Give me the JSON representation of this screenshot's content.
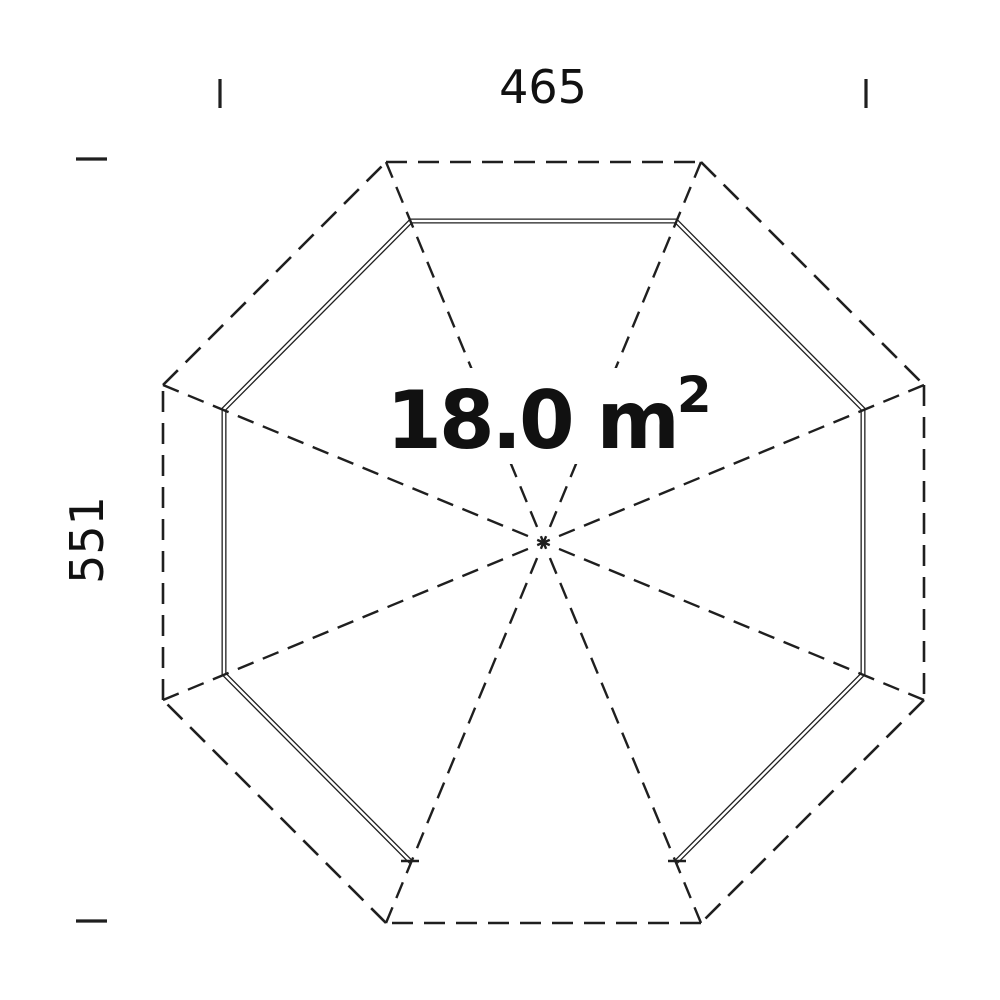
{
  "diagram": {
    "type": "floor-plan",
    "shape": "octagon",
    "area_label": {
      "main": "18.0 m",
      "superscript": "2"
    },
    "dimensions": {
      "width_label": "465",
      "height_label": "551"
    }
  },
  "colors": {
    "line": "#1f1f1f",
    "text": "#111111",
    "background": "#ffffff"
  },
  "geometry": {
    "canvas": {
      "width": 1000,
      "height": 1000
    },
    "center": [
      543.5,
      542.5
    ],
    "outer_octagon": [
      [
        386,
        162
      ],
      [
        701,
        162
      ],
      [
        924,
        385
      ],
      [
        924,
        700
      ],
      [
        701,
        923
      ],
      [
        386,
        923
      ],
      [
        163,
        700
      ],
      [
        163,
        385
      ]
    ],
    "inner_wall": [
      [
        411,
        862
      ],
      [
        224,
        674
      ],
      [
        224,
        409
      ],
      [
        411,
        221
      ],
      [
        676,
        221
      ],
      [
        863,
        409
      ],
      [
        863,
        674
      ],
      [
        676,
        862
      ]
    ],
    "door_caps": [
      [
        [
          401,
          861
        ],
        [
          419,
          861
        ]
      ],
      [
        [
          668,
          861
        ],
        [
          686,
          861
        ]
      ]
    ],
    "ticks": [
      [
        [
          220,
          79
        ],
        [
          220,
          108
        ]
      ],
      [
        [
          866,
          79
        ],
        [
          866,
          108
        ]
      ],
      [
        [
          76,
          159
        ],
        [
          107,
          159
        ]
      ],
      [
        [
          76,
          921
        ],
        [
          107,
          921
        ]
      ]
    ],
    "label_mask": [
      395,
      368,
      320,
      96
    ]
  }
}
